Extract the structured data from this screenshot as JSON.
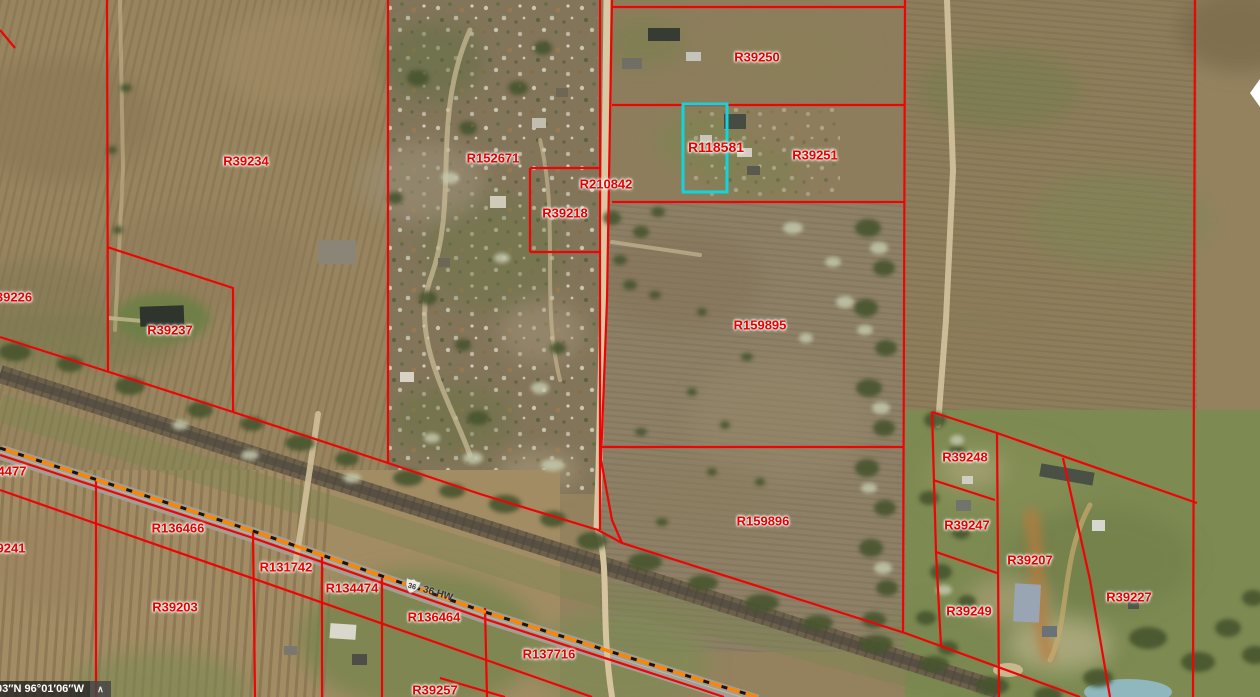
{
  "map": {
    "type": "county-gis-parcel-viewer",
    "selected_parcel": {
      "id": "R118581",
      "x": 683,
      "y": 104,
      "width": 44,
      "height": 88,
      "outline_color": "#12d4dc"
    },
    "parcels": [
      {
        "id": "R39250",
        "x": 757,
        "y": 57
      },
      {
        "id": "R118581",
        "x": 716,
        "y": 147,
        "selected": true
      },
      {
        "id": "R39251",
        "x": 815,
        "y": 155
      },
      {
        "id": "R152671",
        "x": 493,
        "y": 158
      },
      {
        "id": "R39234",
        "x": 246,
        "y": 161
      },
      {
        "id": "R210842",
        "x": 606,
        "y": 184
      },
      {
        "id": "R39218",
        "x": 565,
        "y": 213
      },
      {
        "id": "39226",
        "x": 14,
        "y": 297
      },
      {
        "id": "R159895",
        "x": 760,
        "y": 325
      },
      {
        "id": "R39237",
        "x": 170,
        "y": 330
      },
      {
        "id": "R39248",
        "x": 965,
        "y": 457
      },
      {
        "id": "4477",
        "x": 12,
        "y": 471
      },
      {
        "id": "R159896",
        "x": 763,
        "y": 521
      },
      {
        "id": "R39247",
        "x": 967,
        "y": 525
      },
      {
        "id": "R136466",
        "x": 178,
        "y": 528
      },
      {
        "id": "9241",
        "x": 11,
        "y": 548
      },
      {
        "id": "R39207",
        "x": 1030,
        "y": 560
      },
      {
        "id": "R131742",
        "x": 286,
        "y": 567
      },
      {
        "id": "R134474",
        "x": 352,
        "y": 588
      },
      {
        "id": "R39227",
        "x": 1129,
        "y": 597
      },
      {
        "id": "R39203",
        "x": 175,
        "y": 607
      },
      {
        "id": "R39249",
        "x": 969,
        "y": 611
      },
      {
        "id": "R136464",
        "x": 434,
        "y": 617
      },
      {
        "id": "R137716",
        "x": 549,
        "y": 654
      },
      {
        "id": "R39257",
        "x": 435,
        "y": 690
      }
    ],
    "road_label": {
      "route_number": "36",
      "name": "36 HW"
    },
    "status_bar": {
      "coordinates": "’03″N 96°01′06″W",
      "expand_icon": "∧"
    },
    "colors": {
      "parcel_line": "#ee0404",
      "parcel_label": "#e60000",
      "selected_outline": "#12d4dc",
      "highway_line": "#ff8400",
      "highway_dash": "#151515"
    }
  }
}
